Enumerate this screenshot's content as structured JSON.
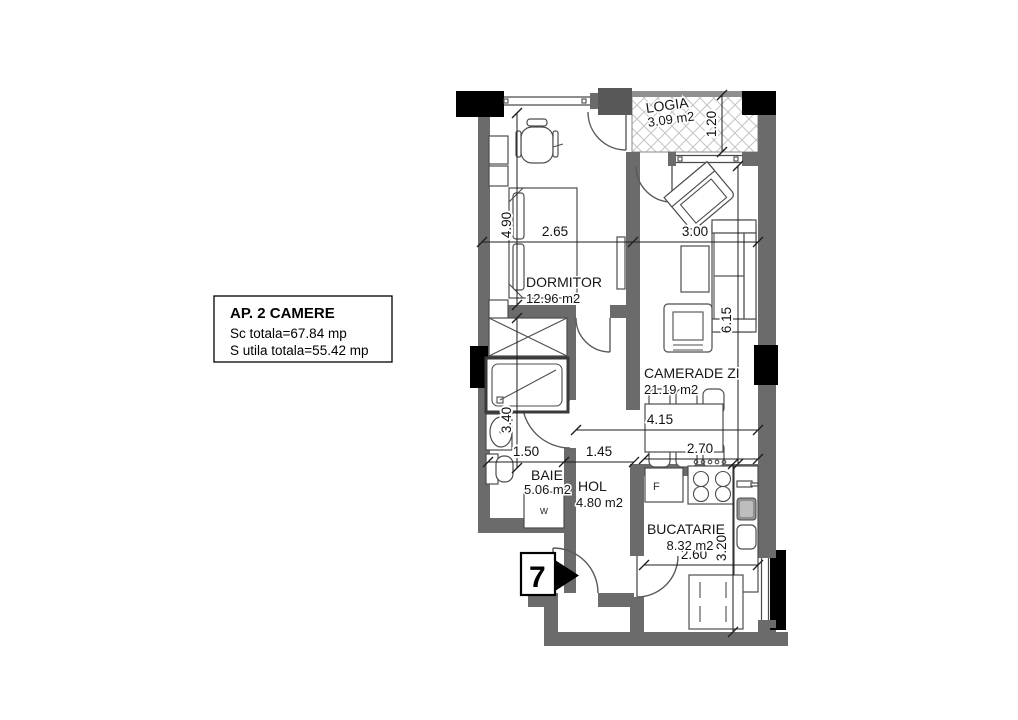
{
  "plan": {
    "title_box": {
      "title": "AP. 2 CAMERE",
      "line1": "Sc totala=67.84 mp",
      "line2": "S utila totala=55.42 mp"
    },
    "rooms": {
      "logia": {
        "name": "LOGIA",
        "area": "3.09 m2"
      },
      "dormitor": {
        "name": "DORMITOR",
        "area": "12.96 m2"
      },
      "camera_zi": {
        "name": "CAMERADE ZI",
        "area": "21.19 m2"
      },
      "baie": {
        "name": "BAIE",
        "area": "5.06 m2"
      },
      "hol": {
        "name": "HOL",
        "area": "4.80 m2"
      },
      "bucatarie": {
        "name": "BUCATARIE",
        "area": "8.32 m2"
      }
    },
    "dims": {
      "d265": "2.65",
      "d300": "3.00",
      "d490": "4.90",
      "d615": "6.15",
      "d120": "1.20",
      "d340": "3.40",
      "d150": "1.50",
      "d145": "1.45",
      "d415": "4.15",
      "d270": "2.70",
      "d260": "2.60",
      "d320": "3.20"
    },
    "markers": {
      "entrance": "7",
      "washer": "w",
      "fridge": "F"
    },
    "colors": {
      "wall": "#6b6b6b",
      "column": "#000000",
      "paper": "#ffffff"
    }
  }
}
